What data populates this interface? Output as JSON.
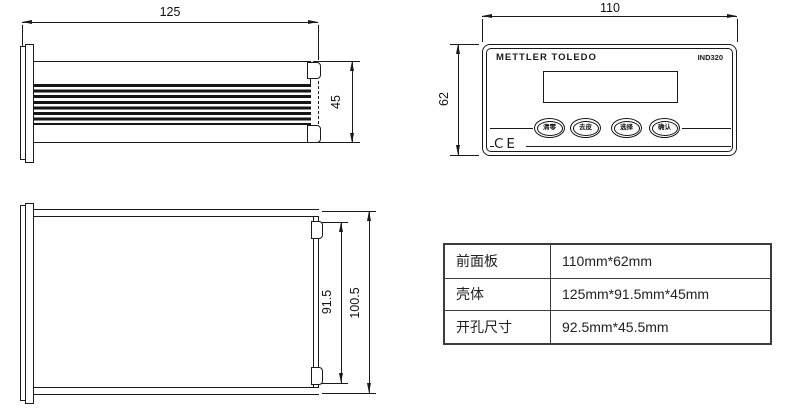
{
  "drawing": {
    "side_view": {
      "width_dim": "125",
      "height_dim": "45"
    },
    "front_view": {
      "width_dim": "110",
      "height_dim": "62",
      "brand": "METTLER TOLEDO",
      "model": "IND320",
      "ce_mark": "CE",
      "buttons": [
        {
          "label": "清零"
        },
        {
          "label": "去皮"
        },
        {
          "label": "选择"
        },
        {
          "label": "确认"
        }
      ]
    },
    "top_view": {
      "inner_dim": "91.5",
      "outer_dim": "100.5"
    }
  },
  "spec_table": {
    "rows": [
      {
        "label": "前面板",
        "value": "110mm*62mm"
      },
      {
        "label": "壳体",
        "value": "125mm*91.5mm*45mm"
      },
      {
        "label": "开孔尺寸",
        "value": "92.5mm*45.5mm"
      }
    ]
  }
}
